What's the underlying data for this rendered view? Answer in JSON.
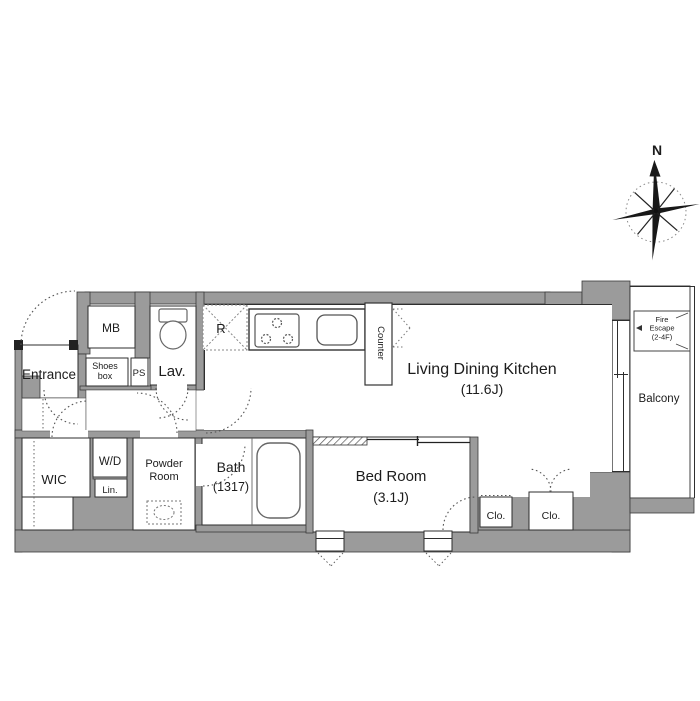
{
  "title": "apartment-floor-plan",
  "compass": {
    "north_label": "N"
  },
  "colors": {
    "wall": "#9b9b9b",
    "outline": "#2e2e2e",
    "dotted_line": "#555555"
  },
  "rooms": {
    "entrance": {
      "label": "Entrance"
    },
    "meter_box": {
      "label": "MB"
    },
    "shoes_box": {
      "line1": "Shoes",
      "line2": "box"
    },
    "pipe_space": {
      "label": "PS"
    },
    "lavatory": {
      "label": "Lav."
    },
    "refrigerator_space": {
      "label": "R"
    },
    "kitchen_counter": {
      "label": "Counter"
    },
    "ldk": {
      "label": "Living Dining Kitchen",
      "size": "(11.6J)"
    },
    "balcony": {
      "label": "Balcony"
    },
    "fire_escape": {
      "line1": "Fire",
      "line2": "Escape",
      "line3": "(2-4F)"
    },
    "wic": {
      "label": "WIC"
    },
    "washer_dryer": {
      "label": "W/D"
    },
    "linen": {
      "label": "Lin."
    },
    "powder_room": {
      "line1": "Powder",
      "line2": "Room"
    },
    "bath": {
      "label": "Bath",
      "size": "(1317)"
    },
    "bedroom": {
      "label": "Bed Room",
      "size": "(3.1J)"
    },
    "closet1": {
      "label": "Clo."
    },
    "closet2": {
      "label": "Clo."
    }
  }
}
